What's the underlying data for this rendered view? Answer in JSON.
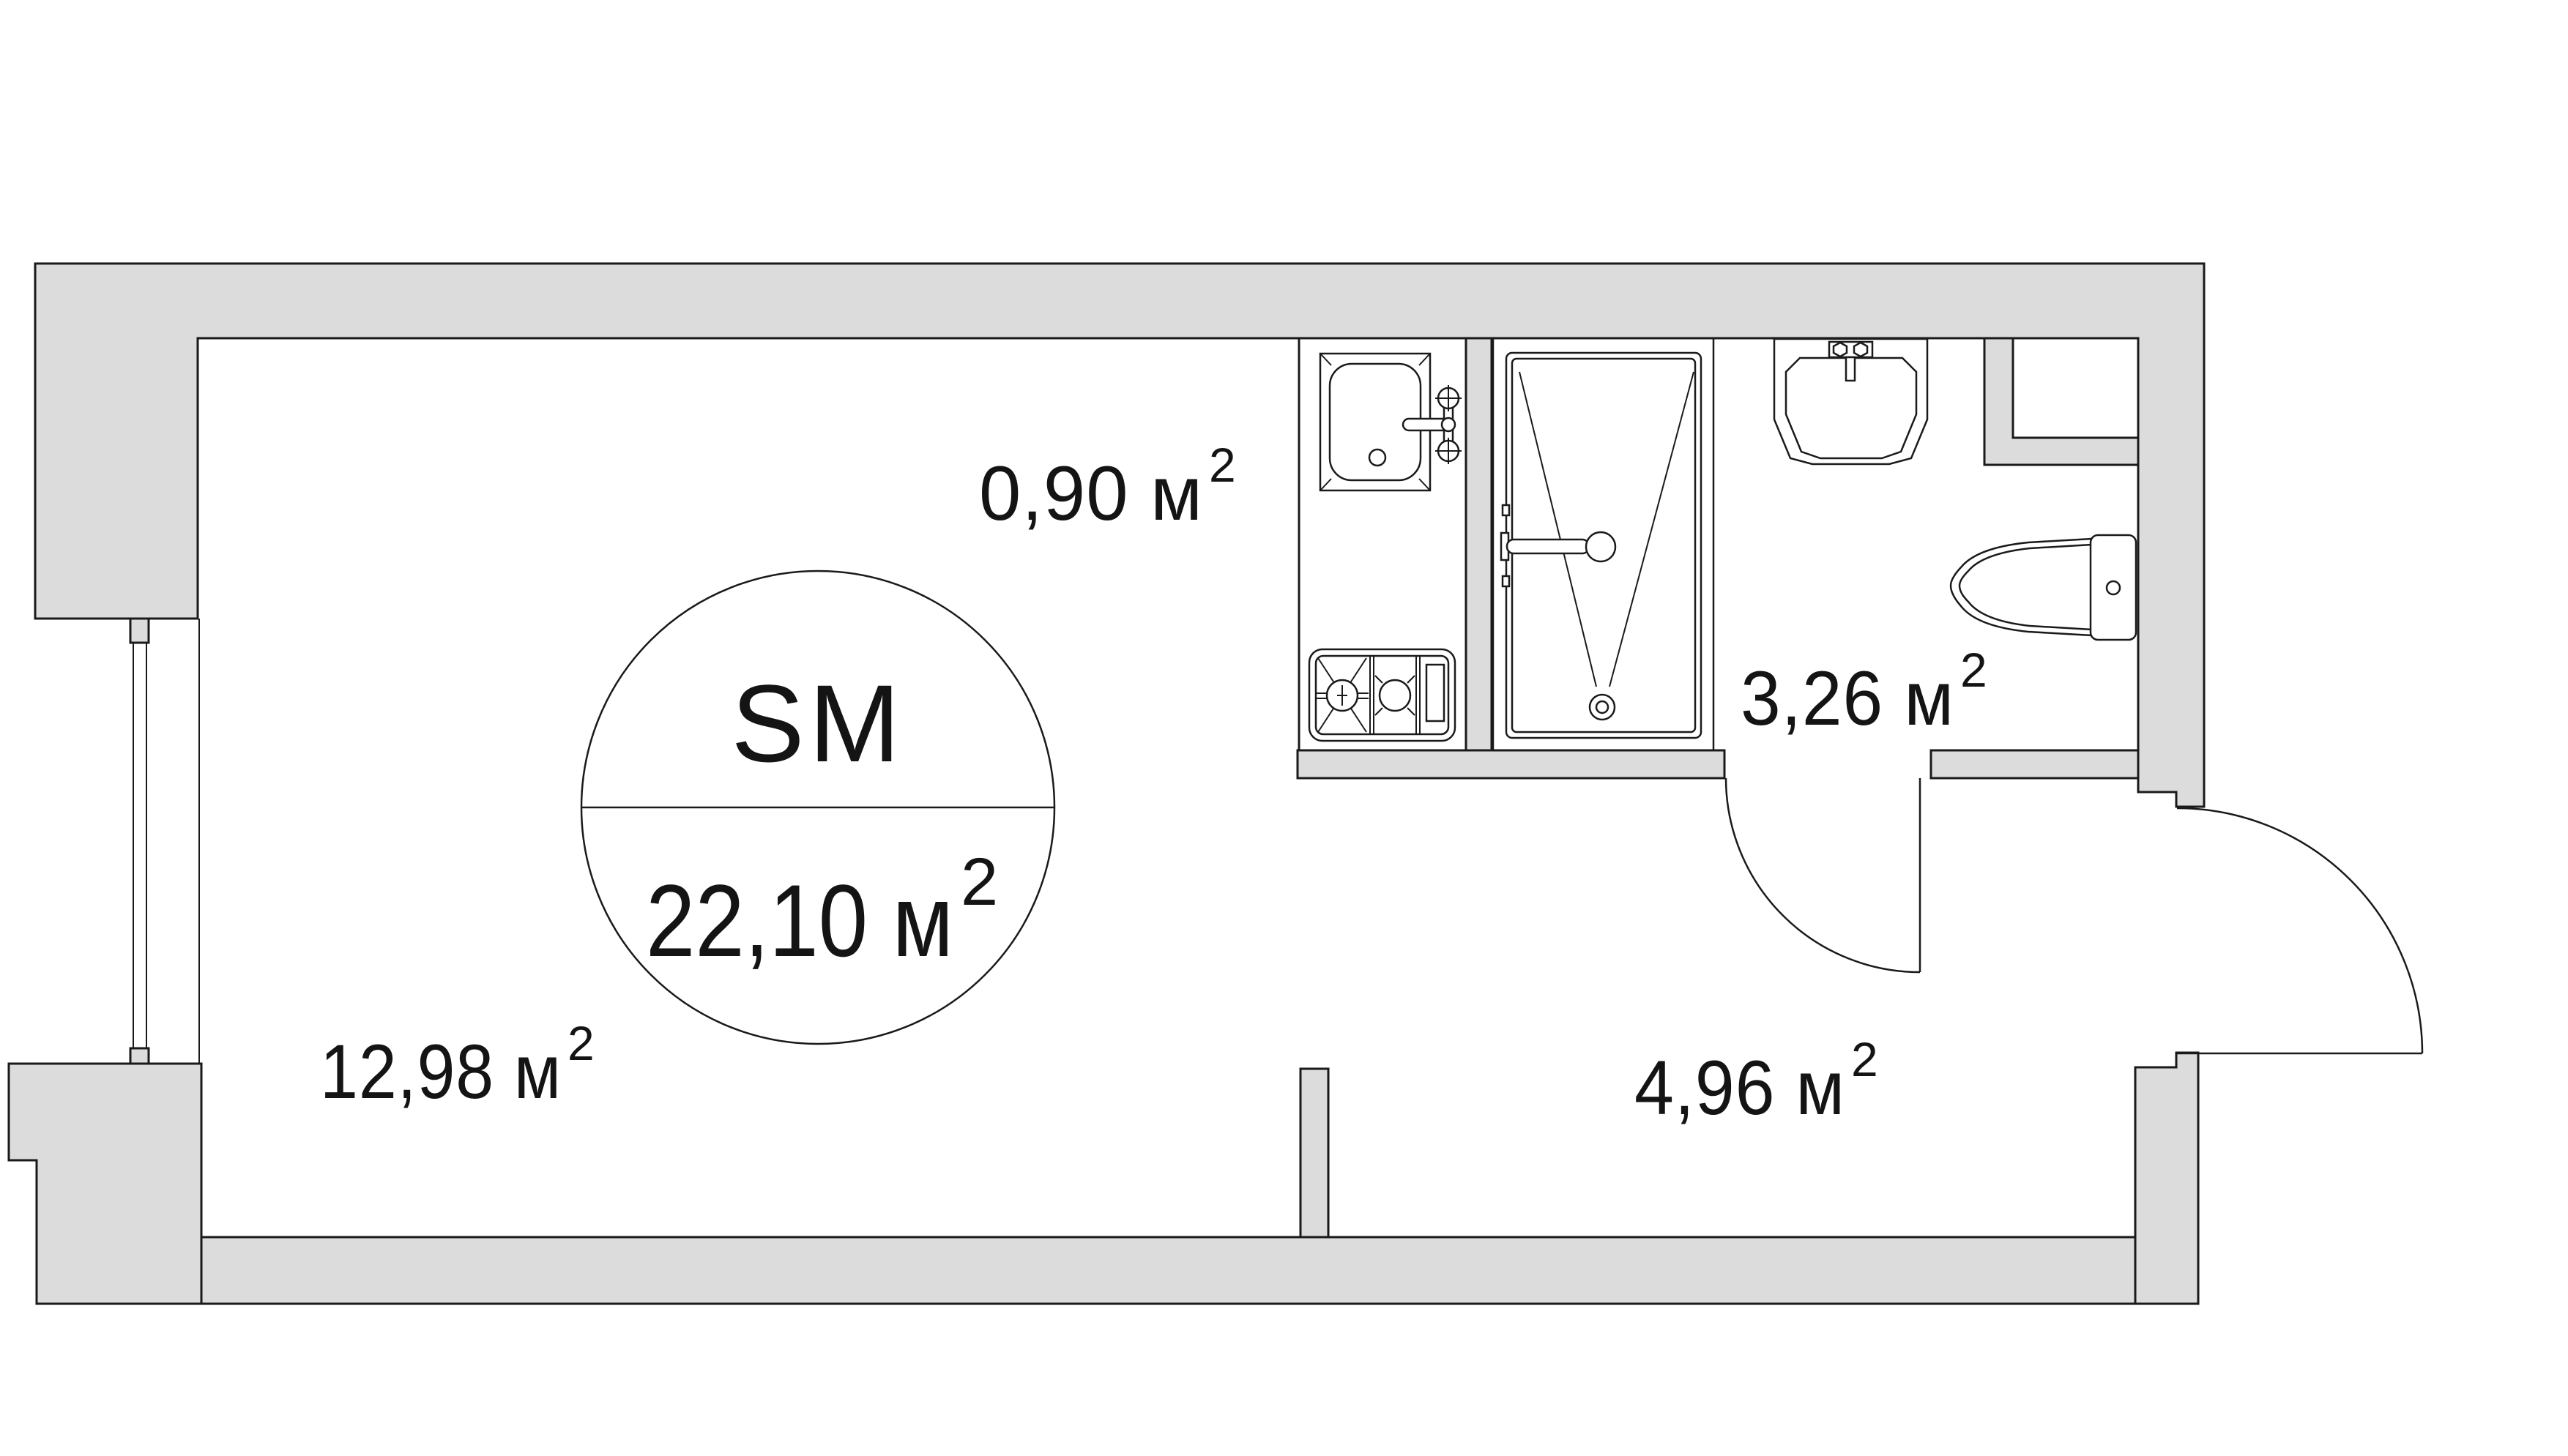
{
  "colors": {
    "wall_fill": "#dcdcdc",
    "line": "#1a1a1a",
    "background": "#ffffff",
    "text": "#141414"
  },
  "stamp": {
    "title": "SM",
    "area": "22,10 м",
    "area_sup": "2"
  },
  "rooms": [
    {
      "key": "kitchen-niche",
      "area": "0,90 м",
      "area_sup": "2"
    },
    {
      "key": "living-area",
      "area": "12,98 м",
      "area_sup": "2"
    },
    {
      "key": "bathroom",
      "area": "3,26 м",
      "area_sup": "2"
    },
    {
      "key": "hallway",
      "area": "4,96 м",
      "area_sup": "2"
    }
  ]
}
